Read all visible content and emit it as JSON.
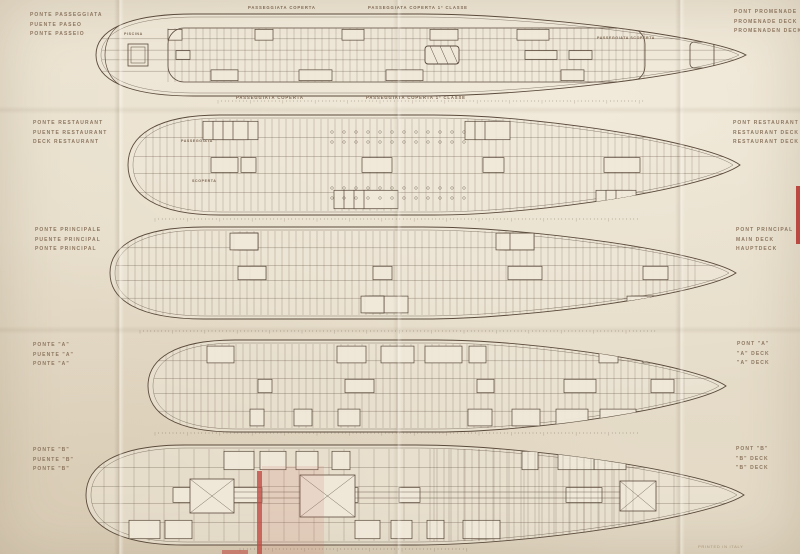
{
  "sheet": {
    "credit": "PRINTED IN ITALY",
    "colors": {
      "paper": "#e7decb",
      "ink": "#5a4a3b",
      "label": "#8d7760",
      "accent_red": "#b5362f"
    }
  },
  "decks": [
    {
      "name": "promenade-deck",
      "labels_left": [
        "PONTE PASSEGGIATA",
        "PUENTE PASEO",
        "PONTE PASSEIO"
      ],
      "labels_right": [
        "PONT PROMENADE",
        "PROMENADE DECK",
        "PROMENADEN DECK"
      ]
    },
    {
      "name": "restaurant-deck",
      "labels_left": [
        "PONTE RESTAURANT",
        "PUENTE RESTAURANT",
        "DECK RESTAURANT"
      ],
      "labels_right": [
        "PONT RESTAURANT",
        "RESTAURANT DECK",
        "RESTAURANT DECK"
      ]
    },
    {
      "name": "main-deck",
      "labels_left": [
        "PONTE PRINCIPALE",
        "PUENTE PRINCIPAL",
        "PONTE PRINCIPAL"
      ],
      "labels_right": [
        "PONT PRINCIPAL",
        "MAIN DECK",
        "HAUPTDECK"
      ]
    },
    {
      "name": "a-deck",
      "labels_left": [
        "PONTE \"A\"",
        "PUENTE \"A\"",
        "PONTE \"A\""
      ],
      "labels_right": [
        "PONT \"A\"",
        "\"A\" DECK",
        "\"A\" DECK"
      ]
    },
    {
      "name": "b-deck",
      "labels_left": [
        "PONTE \"B\"",
        "PUENTE \"B\"",
        "PONTE \"B\""
      ],
      "labels_right": [
        "PONT \"B\"",
        "\"B\" DECK",
        "\"B\" DECK"
      ]
    }
  ],
  "annotations": {
    "prom_coperta_aft": "PASSEGGIATA COPERTA",
    "prom_coperta_fwd": "PASSEGGIATA COPERTA 1ª CLASSE",
    "prom_coperta_aft_lower": "PASSEGGIATA COPERTA",
    "prom_coperta_fwd_lower": "PASSEGGIATA COPERTA 1ª CLASSE",
    "prom_scoperta": "PASSEGGIATA SCOPERTA",
    "piscina": "PISCINA",
    "passeggiata": "PASSEGGIATA",
    "scoperta": "SCOPERTA"
  }
}
